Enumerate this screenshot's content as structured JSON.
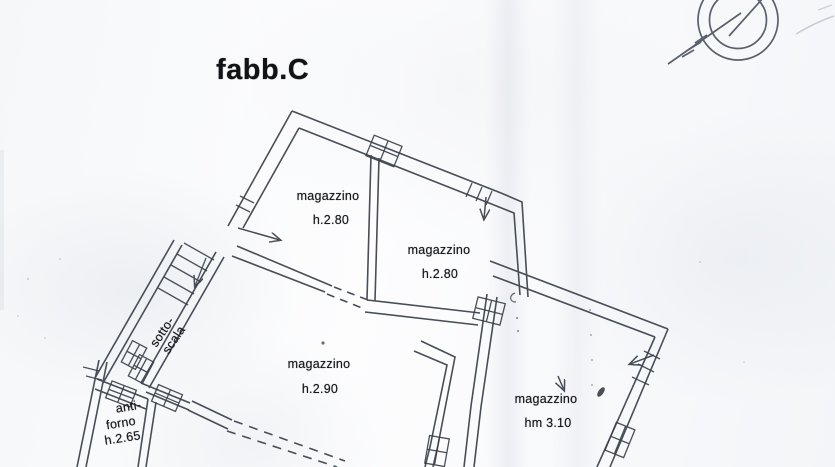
{
  "page": {
    "title": "fabb.C",
    "document_type": "floor-plan-scan"
  },
  "colors": {
    "ink": "#39404a",
    "text_ink": "#17191d",
    "paper": "#f8fafc"
  },
  "plan": {
    "rooms": [
      {
        "name": "magazzino-top-left",
        "label": "magazzino",
        "height": "h.2.80"
      },
      {
        "name": "magazzino-top-right",
        "label": "magazzino",
        "height": "h.2.80"
      },
      {
        "name": "magazzino-center",
        "label": "magazzino",
        "height": "h.2.90"
      },
      {
        "name": "magazzino-right",
        "label": "magazzino",
        "height": "hm 3.10"
      },
      {
        "name": "sotto-scala",
        "label_line1": "sotto-",
        "label_line2": "scala"
      },
      {
        "name": "anti-forno",
        "label_line1": "anti-",
        "label_line2": "forno",
        "height": "h.2.65"
      }
    ]
  }
}
